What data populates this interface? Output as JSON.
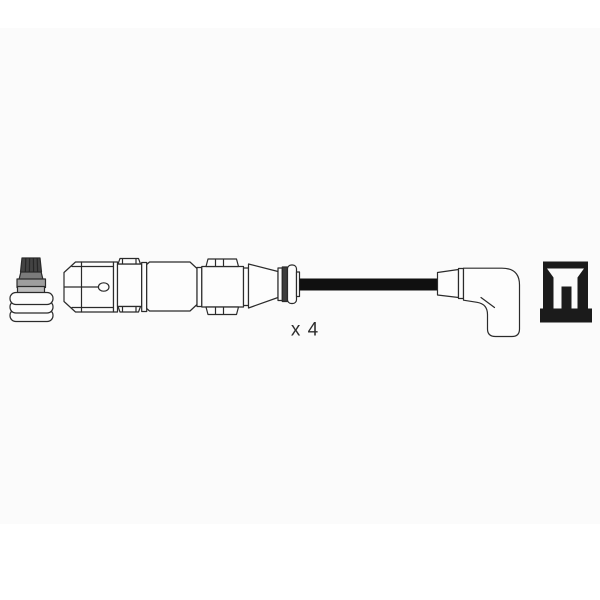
{
  "image": {
    "quantity_label": "x 4"
  },
  "colors": {
    "canvas": "#ffffff",
    "panel": "#fbfbfb",
    "outline": "#2b2b2b",
    "cable_black": "#101010",
    "cap_dark_gray": "#434343",
    "cap_knurl": "#262626",
    "neck_gray": "#7b7b7b",
    "collar_gray": "#9e9e9e",
    "collar_light_gray": "#bdbdbd",
    "ring_dark_gray": "#3d3d3d",
    "icon_black": "#1b1b1b",
    "label_gray": "#2e2e2e"
  }
}
